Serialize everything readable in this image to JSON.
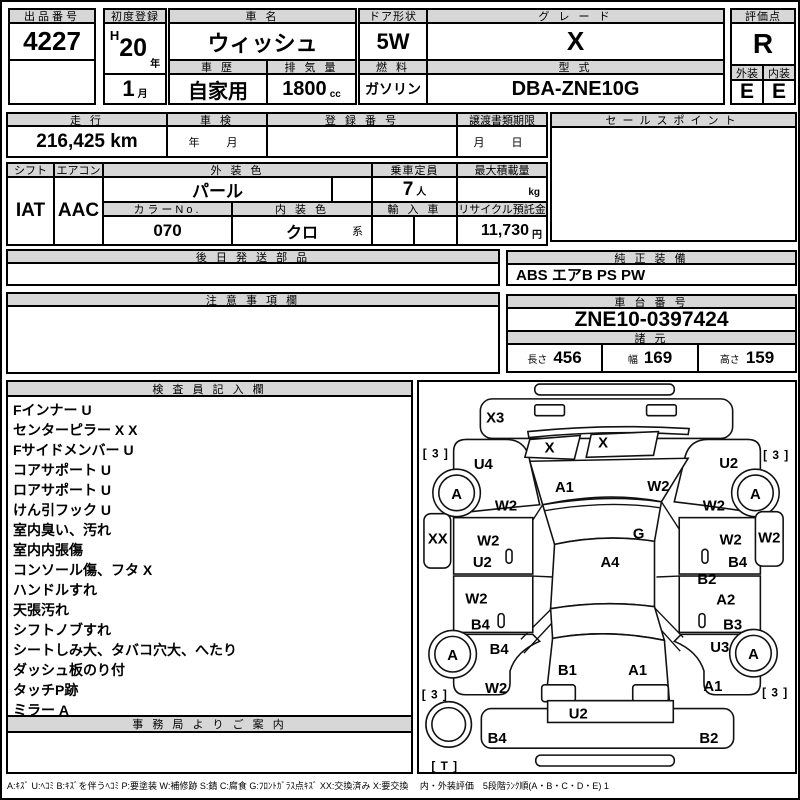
{
  "header": {
    "auction_no": {
      "label": "出品番号",
      "value": "4227"
    },
    "first_reg": {
      "label": "初度登録",
      "era": "H",
      "year": "20",
      "year_unit": "年",
      "month": "1",
      "month_unit": "月"
    },
    "car_name": {
      "label": "車 名",
      "value": "ウィッシュ"
    },
    "history": {
      "label": "車 歴",
      "value": "自家用"
    },
    "displacement": {
      "label": "排 気 量",
      "value": "1800",
      "unit": "cc"
    },
    "door": {
      "label": "ドア形状",
      "value": "5W"
    },
    "fuel": {
      "label": "燃 料",
      "value": "ガソリン"
    },
    "grade": {
      "label": "グ レ ー ド",
      "value": "X"
    },
    "model_code": {
      "label": "型 式",
      "value": "DBA-ZNE10G"
    },
    "score": {
      "label": "評価点",
      "value": "R"
    },
    "exterior": {
      "label": "外装",
      "value": "E"
    },
    "interior": {
      "label": "内装",
      "value": "E"
    }
  },
  "registration": {
    "mileage": {
      "label": "走 行",
      "value": "216,425 km"
    },
    "shaken": {
      "label": "車 検",
      "placeholder": "年　月"
    },
    "reg_no": {
      "label": "登 録 番 号",
      "value": ""
    },
    "deadline": {
      "label": "譲渡書類期限",
      "placeholder": "月　日"
    },
    "sales_point": {
      "label": "セールスポイント",
      "value": ""
    }
  },
  "spec": {
    "shift": {
      "label": "シフト",
      "value": "IAT"
    },
    "aircon": {
      "label": "エアコン",
      "value": "AAC"
    },
    "ext_color": {
      "label": "外 装 色",
      "value": "パール"
    },
    "capacity": {
      "label": "乗車定員",
      "value": "7",
      "unit": "人"
    },
    "max_load": {
      "label": "最大積載量",
      "value": "",
      "unit": "kg"
    },
    "color_no": {
      "label": "カラーNo.",
      "value": "070"
    },
    "int_color": {
      "label": "内 装 色",
      "value": "クロ",
      "suffix": "系"
    },
    "import_car": {
      "label": "輸 入 車",
      "value": ""
    },
    "recycle": {
      "label": "リサイクル預託金",
      "value": "11,730",
      "unit": "円"
    }
  },
  "later_parts": {
    "label": "後 日 発 送 部 品",
    "value": ""
  },
  "oem_equipment": {
    "label": "純 正 装 備",
    "value": "ABS エアB PS PW"
  },
  "notes": {
    "label": "注 意 事 項 欄",
    "value": ""
  },
  "chassis": {
    "label": "車 台 番 号",
    "value": "ZNE10-0397424"
  },
  "dimensions": {
    "label": "諸 元",
    "length_label": "長さ",
    "length": "456",
    "width_label": "幅",
    "width": "169",
    "height_label": "高さ",
    "height": "159"
  },
  "inspector": {
    "label": "検 査 員 記 入 欄",
    "lines": [
      "Fインナー U",
      "センターピラー X X",
      "Fサイドメンバー U",
      "コアサポート U",
      "ロアサポート U",
      "けん引フック U",
      "室内臭い、汚れ",
      "室内内張傷",
      "コンソール傷、フタ X",
      "ハンドルすれ",
      "天張汚れ",
      "シフトノブすれ",
      "シートしみ大、タバコ穴大、へたり",
      "ダッシュ板のり付",
      "タッチP跡",
      "ミラー A"
    ]
  },
  "office": {
    "label": "事 務 局 よ り ご 案 内",
    "value": ""
  },
  "diagram": {
    "labels": [
      {
        "part": "front-bumper",
        "code": "X3"
      },
      {
        "part": "tire-front-left-depth",
        "code": "[ 3 ]"
      },
      {
        "part": "tire-front-right-depth",
        "code": "[ 3 ]"
      },
      {
        "part": "fender-front-left",
        "code": "U4"
      },
      {
        "part": "fender-front-right",
        "code": "U2"
      },
      {
        "part": "headlight-left",
        "code": "X"
      },
      {
        "part": "headlight-right",
        "code": "X"
      },
      {
        "part": "hood-left",
        "code": "A1"
      },
      {
        "part": "hood-right",
        "code": "W2"
      },
      {
        "part": "wheel-front-left",
        "code": "A"
      },
      {
        "part": "wheel-front-right",
        "code": "A"
      },
      {
        "part": "side-front-left",
        "code": "W2"
      },
      {
        "part": "side-front-right",
        "code": "W2"
      },
      {
        "part": "windshield",
        "code": "G"
      },
      {
        "part": "mirror-left",
        "code": "XX"
      },
      {
        "part": "mirror-right",
        "code": "W2"
      },
      {
        "part": "door-front-left-upper",
        "code": "W2"
      },
      {
        "part": "door-front-left-lower",
        "code": "U2"
      },
      {
        "part": "door-front-right-upper",
        "code": "W2"
      },
      {
        "part": "door-front-right-lower",
        "code": "B4"
      },
      {
        "part": "roof",
        "code": "A4"
      },
      {
        "part": "side-right-center",
        "code": "B2"
      },
      {
        "part": "door-rear-left-upper",
        "code": "W2"
      },
      {
        "part": "door-rear-left-lower",
        "code": "B4"
      },
      {
        "part": "door-rear-right-upper",
        "code": "A2"
      },
      {
        "part": "door-rear-right-lower",
        "code": "B3"
      },
      {
        "part": "quarter-rear-left",
        "code": "B4"
      },
      {
        "part": "quarter-rear-right",
        "code": "U3"
      },
      {
        "part": "wheel-rear-left",
        "code": "A"
      },
      {
        "part": "wheel-rear-right",
        "code": "A"
      },
      {
        "part": "quarter-rear-left-lower",
        "code": "W2"
      },
      {
        "part": "quarter-rear-right-lower",
        "code": "A1"
      },
      {
        "part": "tire-rear-left-depth",
        "code": "[ 3 ]"
      },
      {
        "part": "tire-rear-right-depth",
        "code": "[ 3 ]"
      },
      {
        "part": "tailgate-left",
        "code": "B1"
      },
      {
        "part": "tailgate-right",
        "code": "A1"
      },
      {
        "part": "rear-panel",
        "code": "U2"
      },
      {
        "part": "rear-bumper-left",
        "code": "B4"
      },
      {
        "part": "rear-bumper-right",
        "code": "B2"
      },
      {
        "part": "spare-tire",
        "code": "[ T ]"
      }
    ]
  },
  "legend": "A:ｷｽﾞ U:ﾍｺﾐ B:ｷｽﾞを伴うﾍｺﾐ P:要塗装 W:補修跡 S:錆 C:腐食 G:ﾌﾛﾝﾄｶﾞﾗｽ点ｷｽﾞ XX:交換済み X:要交換　 内・外装評価　5段階ﾗﾝｸ順(A・B・C・D・E) 1"
}
